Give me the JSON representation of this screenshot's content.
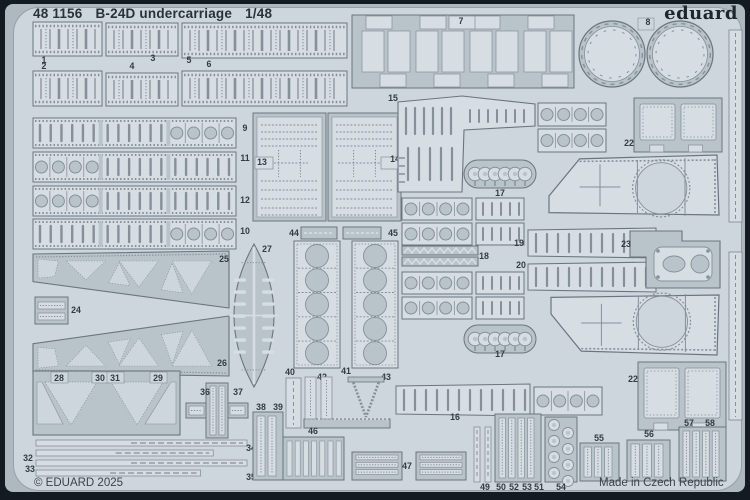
{
  "header": {
    "catalog_number": "48 1156",
    "product_name": "B-24D undercarriage",
    "scale": "1/48",
    "brand_logo": "eduard"
  },
  "footer": {
    "copyright": "© EDUARD 2025",
    "origin": "Made in Czech Republic"
  },
  "colors": {
    "frame": "#141a21",
    "margin": "#aeb8c0",
    "plate": "#cdd6dc",
    "part": "#b9c3ca",
    "light": "#d7dee3",
    "outline": "#6a7580",
    "detail": "#859098",
    "text": "#333b43"
  },
  "parts": [
    {
      "n": "1",
      "t": "ribbed",
      "x": 33,
      "y": 22,
      "w": 69,
      "h": 34,
      "lx": 44,
      "ly": 63
    },
    {
      "n": "3",
      "t": "ribbed",
      "x": 106,
      "y": 23,
      "w": 72,
      "h": 33,
      "lx": 153,
      "ly": 61
    },
    {
      "n": "5",
      "t": "ribbed",
      "x": 182,
      "y": 23,
      "w": 165,
      "h": 35,
      "lx": 189,
      "ly": 63
    },
    {
      "n": "2",
      "t": "ribbed",
      "x": 33,
      "y": 71,
      "w": 69,
      "h": 35,
      "lx": 44,
      "ly": 69
    },
    {
      "n": "4",
      "t": "ribbed",
      "x": 106,
      "y": 73,
      "w": 72,
      "h": 33,
      "lx": 132,
      "ly": 69
    },
    {
      "n": "6",
      "t": "ribbed",
      "x": 182,
      "y": 71,
      "w": 165,
      "h": 35,
      "lx": 209,
      "ly": 67
    },
    {
      "n": "7",
      "t": "grid",
      "x": 352,
      "y": 15,
      "w": 222,
      "h": 73,
      "lx": 461,
      "ly": 24
    },
    {
      "n": "8",
      "t": "discs",
      "x": 578,
      "y": 16,
      "w": 136,
      "h": 74,
      "lx": 648,
      "ly": 25
    },
    {
      "n": "9",
      "t": "slotstrip",
      "x": 33,
      "y": 118,
      "w": 203,
      "h": 30,
      "p": "ssc",
      "lx": 245,
      "ly": 131
    },
    {
      "n": "11",
      "t": "slotstrip",
      "x": 33,
      "y": 152,
      "w": 203,
      "h": 30,
      "p": "css",
      "lx": 245,
      "ly": 161
    },
    {
      "n": "12",
      "t": "slotstrip",
      "x": 33,
      "y": 186,
      "w": 203,
      "h": 30,
      "p": "css",
      "lx": 245,
      "ly": 203
    },
    {
      "n": "10",
      "t": "slotstrip",
      "x": 33,
      "y": 219,
      "w": 203,
      "h": 30,
      "p": "ssc",
      "lx": 245,
      "ly": 234
    },
    {
      "n": "13",
      "t": "panel",
      "x": 253,
      "y": 113,
      "w": 73,
      "h": 108,
      "nb": "l",
      "lx": 262,
      "ly": 165
    },
    {
      "n": "14",
      "t": "panel",
      "x": 328,
      "y": 113,
      "w": 73,
      "h": 108,
      "nb": "r",
      "lx": 395,
      "ly": 162
    },
    {
      "n": "15",
      "t": "lpanel",
      "x": 398,
      "y": 96,
      "w": 137,
      "h": 96,
      "lx": 393,
      "ly": 101
    },
    {
      "t": "circstrip",
      "x": 538,
      "y": 103,
      "w": 68,
      "h": 23
    },
    {
      "t": "circstrip",
      "x": 538,
      "y": 129,
      "w": 68,
      "h": 23
    },
    {
      "n": "17",
      "t": "grommet",
      "x": 464,
      "y": 160,
      "w": 72,
      "h": 28,
      "lx": 500,
      "ly": 196
    },
    {
      "n": "22",
      "t": "frame2",
      "x": 634,
      "y": 98,
      "w": 88,
      "h": 54,
      "lx": 629,
      "ly": 146
    },
    {
      "t": "bigpanel",
      "x": 549,
      "y": 155,
      "w": 170,
      "h": 64
    },
    {
      "t": "circstrip",
      "x": 402,
      "y": 198,
      "w": 70,
      "h": 22
    },
    {
      "t": "slotsmall",
      "x": 476,
      "y": 198,
      "w": 48,
      "h": 22
    },
    {
      "t": "circstrip",
      "x": 402,
      "y": 223,
      "w": 70,
      "h": 22
    },
    {
      "t": "slotsmall",
      "x": 476,
      "y": 223,
      "w": 48,
      "h": 22
    },
    {
      "n": "19",
      "t": "taperslot",
      "x": 528,
      "y": 228,
      "w": 128,
      "h": 30,
      "lx": 519,
      "ly": 246
    },
    {
      "n": "20",
      "t": "taperslot",
      "x": 528,
      "y": 262,
      "w": 128,
      "h": 30,
      "lx": 521,
      "ly": 268
    },
    {
      "n": "18",
      "t": "comb18",
      "x": 402,
      "y": 246,
      "w": 76,
      "h": 20,
      "lx": 484,
      "ly": 259
    },
    {
      "t": "circstrip",
      "x": 402,
      "y": 272,
      "w": 70,
      "h": 22
    },
    {
      "t": "slotsmall",
      "x": 476,
      "y": 272,
      "w": 48,
      "h": 22
    },
    {
      "t": "circstrip",
      "x": 402,
      "y": 297,
      "w": 70,
      "h": 22
    },
    {
      "t": "slotsmall",
      "x": 476,
      "y": 297,
      "w": 48,
      "h": 22
    },
    {
      "t": "bigpanel",
      "x": 551,
      "y": 291,
      "w": 168,
      "h": 64,
      "f": 1
    },
    {
      "n": "23",
      "t": "bracket",
      "x": 630,
      "y": 231,
      "w": 90,
      "h": 57,
      "lx": 626,
      "ly": 247
    },
    {
      "n": "17",
      "t": "grommet",
      "x": 464,
      "y": 325,
      "w": 72,
      "h": 28,
      "lx": 500,
      "ly": 357
    },
    {
      "n": "22",
      "t": "frame2",
      "x": 638,
      "y": 362,
      "w": 88,
      "h": 68,
      "lx": 633,
      "ly": 382
    },
    {
      "n": "24",
      "t": "bars2",
      "x": 35,
      "y": 297,
      "w": 33,
      "h": 27,
      "lx": 76,
      "ly": 313
    },
    {
      "n": "25",
      "t": "truss",
      "x": 33,
      "y": 251,
      "w": 196,
      "h": 59,
      "lx": 224,
      "ly": 262
    },
    {
      "n": "26",
      "t": "truss",
      "x": 33,
      "y": 314,
      "w": 196,
      "h": 62,
      "f": 1,
      "lx": 222,
      "ly": 366
    },
    {
      "n": "27",
      "t": "lens",
      "x": 223,
      "y": 244,
      "w": 62,
      "h": 143,
      "lx": 267,
      "ly": 252
    },
    {
      "n": "44",
      "t": "bar44",
      "x": 301,
      "y": 227,
      "w": 36,
      "h": 12,
      "lx": 294,
      "ly": 236
    },
    {
      "n": "45",
      "t": "bar44",
      "x": 343,
      "y": 227,
      "w": 38,
      "h": 12,
      "lx": 393,
      "ly": 236
    },
    {
      "n": "42",
      "t": "plate5",
      "x": 294,
      "y": 241,
      "w": 46,
      "h": 127,
      "lx": 322,
      "ly": 380
    },
    {
      "n": "43",
      "t": "plate5",
      "x": 352,
      "y": 241,
      "w": 46,
      "h": 127,
      "lx": 386,
      "ly": 380
    },
    {
      "n": "28",
      "t": "vframe",
      "x": 33,
      "y": 371,
      "w": 147,
      "h": 64,
      "lx": 59,
      "ly": 381,
      "l2": [
        [
          "30",
          100,
          381
        ],
        [
          "31",
          115,
          381
        ],
        [
          "29",
          158,
          381
        ]
      ]
    },
    {
      "n": "36",
      "t": "cross",
      "x": 186,
      "y": 383,
      "w": 62,
      "h": 55,
      "lx": 205,
      "ly": 395,
      "l2": [
        [
          "37",
          238,
          395
        ]
      ]
    },
    {
      "n": "32",
      "t": "thinstrips",
      "x": 36,
      "y": 440,
      "w": 211,
      "h": 39,
      "lx": 28,
      "ly": 461,
      "l2": [
        [
          "33",
          30,
          472
        ],
        [
          "34",
          251,
          451
        ],
        [
          "35",
          251,
          480
        ]
      ]
    },
    {
      "n": "38",
      "t": "grille",
      "x": 253,
      "y": 412,
      "w": 30,
      "h": 68,
      "b": 2,
      "lx": 261,
      "ly": 410,
      "l2": [
        [
          "39",
          278,
          410
        ]
      ]
    },
    {
      "n": "40",
      "t": "bar",
      "x": 286,
      "y": 378,
      "w": 15,
      "h": 50,
      "lx": 290,
      "ly": 375
    },
    {
      "n": "41",
      "t": "uframe",
      "x": 304,
      "y": 377,
      "w": 86,
      "h": 51,
      "lx": 346,
      "ly": 374
    },
    {
      "n": "46",
      "t": "comb46",
      "x": 283,
      "y": 437,
      "w": 61,
      "h": 43,
      "lx": 313,
      "ly": 434
    },
    {
      "n": "16",
      "t": "taperslot",
      "x": 396,
      "y": 384,
      "w": 134,
      "h": 32,
      "lx": 455,
      "ly": 420
    },
    {
      "t": "circstrip",
      "x": 534,
      "y": 387,
      "w": 68,
      "h": 28
    },
    {
      "n": "47",
      "t": "grille",
      "x": 352,
      "y": 452,
      "w": 50,
      "h": 28,
      "b": 3,
      "horiz": 1,
      "lx": 407,
      "ly": 469
    },
    {
      "t": "grille",
      "x": 416,
      "y": 452,
      "w": 50,
      "h": 28,
      "b": 3,
      "horiz": 1
    },
    {
      "n": "49",
      "t": "strips2",
      "x": 474,
      "y": 427,
      "w": 17,
      "h": 55,
      "lx": 485,
      "ly": 490
    },
    {
      "n": "50",
      "t": "grille",
      "x": 495,
      "y": 414,
      "w": 46,
      "h": 68,
      "b": 4,
      "lx": 501,
      "ly": 490,
      "l2": [
        [
          "52",
          514,
          490
        ],
        [
          "53",
          527,
          490
        ],
        [
          "51",
          539,
          490
        ]
      ]
    },
    {
      "n": "54",
      "t": "chain",
      "x": 545,
      "y": 417,
      "w": 32,
      "h": 65,
      "lx": 561,
      "ly": 490
    },
    {
      "n": "55",
      "t": "grille",
      "x": 580,
      "y": 443,
      "w": 39,
      "h": 38,
      "b": 3,
      "lx": 599,
      "ly": 441
    },
    {
      "n": "56",
      "t": "grille",
      "x": 627,
      "y": 440,
      "w": 43,
      "h": 41,
      "b": 3,
      "lx": 649,
      "ly": 437
    },
    {
      "n": "57",
      "t": "grille",
      "x": 679,
      "y": 427,
      "w": 47,
      "h": 54,
      "b": 4,
      "lx": 689,
      "ly": 426,
      "l2": [
        [
          "58",
          710,
          426
        ]
      ]
    },
    {
      "t": "bar",
      "x": 729,
      "y": 30,
      "w": 13,
      "h": 192
    },
    {
      "t": "bar",
      "x": 729,
      "y": 252,
      "w": 13,
      "h": 168
    }
  ]
}
